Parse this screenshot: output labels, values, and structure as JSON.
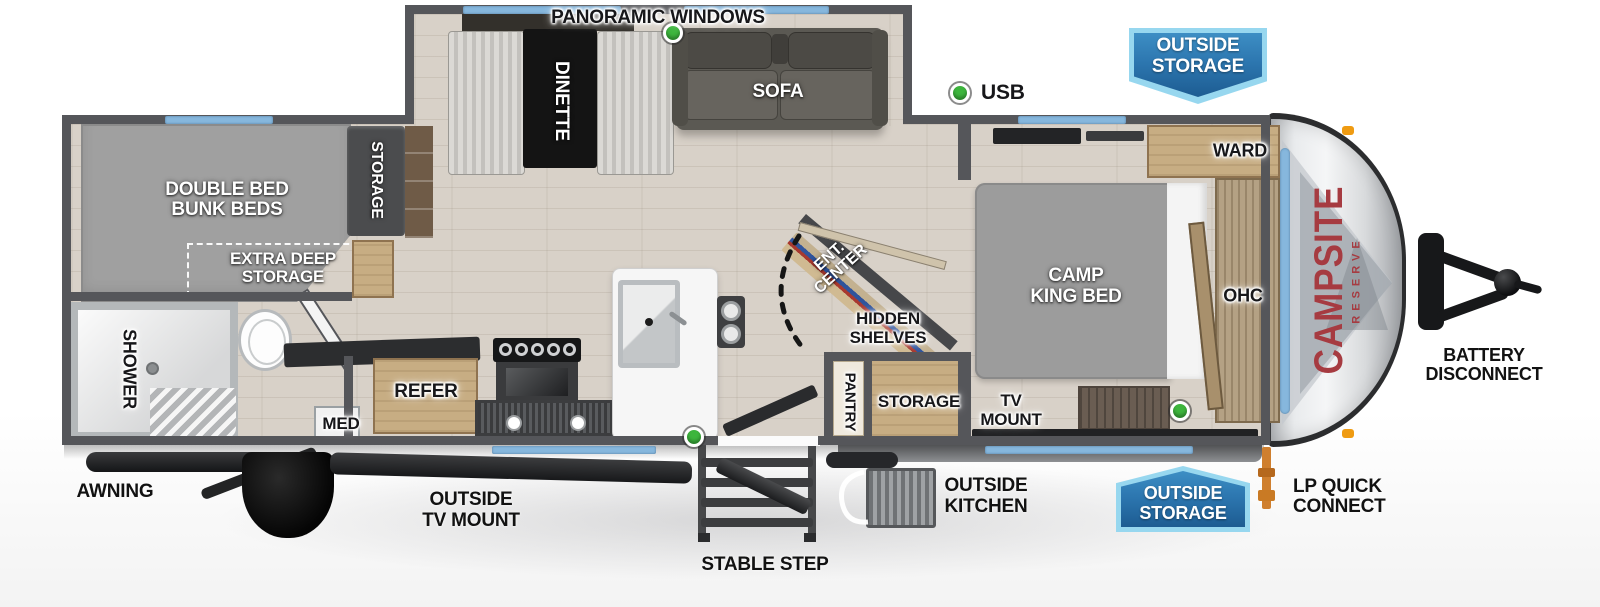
{
  "meta": {
    "width": 1600,
    "height": 607,
    "description": "Travel trailer RV floor plan diagram"
  },
  "brand": {
    "name": "CAMPSITE",
    "series": "RESERVE"
  },
  "labels": {
    "panoramic_windows": "PANORAMIC WINDOWS",
    "usb": "USB",
    "sofa": "SOFA",
    "dinette": "DINETTE",
    "bunk_beds": [
      "DOUBLE BED",
      "BUNK BEDS"
    ],
    "extra_deep_storage": [
      "EXTRA DEEP",
      "STORAGE"
    ],
    "bunk_storage": "STORAGE",
    "shower": "SHOWER",
    "med": "MED",
    "refer": "REFER",
    "ent_center": [
      "ENT.",
      "CENTER"
    ],
    "hidden_shelves": [
      "HIDDEN",
      "SHELVES"
    ],
    "pantry": "PANTRY",
    "mid_storage": "STORAGE",
    "camp_king_bed": [
      "CAMP",
      "KING BED"
    ],
    "ward": "WARD",
    "ohc": "OHC",
    "tv_mount": [
      "TV",
      "MOUNT"
    ],
    "awning": "AWNING",
    "outside_tv_mount": [
      "OUTSIDE",
      "TV MOUNT"
    ],
    "stable_step": "STABLE STEP",
    "outside_kitchen": [
      "OUTSIDE",
      "KITCHEN"
    ],
    "lp_quick_connect": [
      "LP QUICK",
      "CONNECT"
    ],
    "battery_disconnect": [
      "BATTERY",
      "DISCONNECT"
    ]
  },
  "badges": {
    "outside_storage": [
      "OUTSIDE",
      "STORAGE"
    ]
  },
  "indicators": {
    "usb_marker_count": 4,
    "usb_color": "#3db53d"
  },
  "colors": {
    "wall": "#55565a",
    "window": "#86b7dd",
    "badge_fill": "#2d77b0",
    "badge_border": "#97d7ef",
    "brand_red": "#a63b41",
    "floor_wood": "#d8d1c8",
    "lp_pipe": "#cf7f2e"
  }
}
